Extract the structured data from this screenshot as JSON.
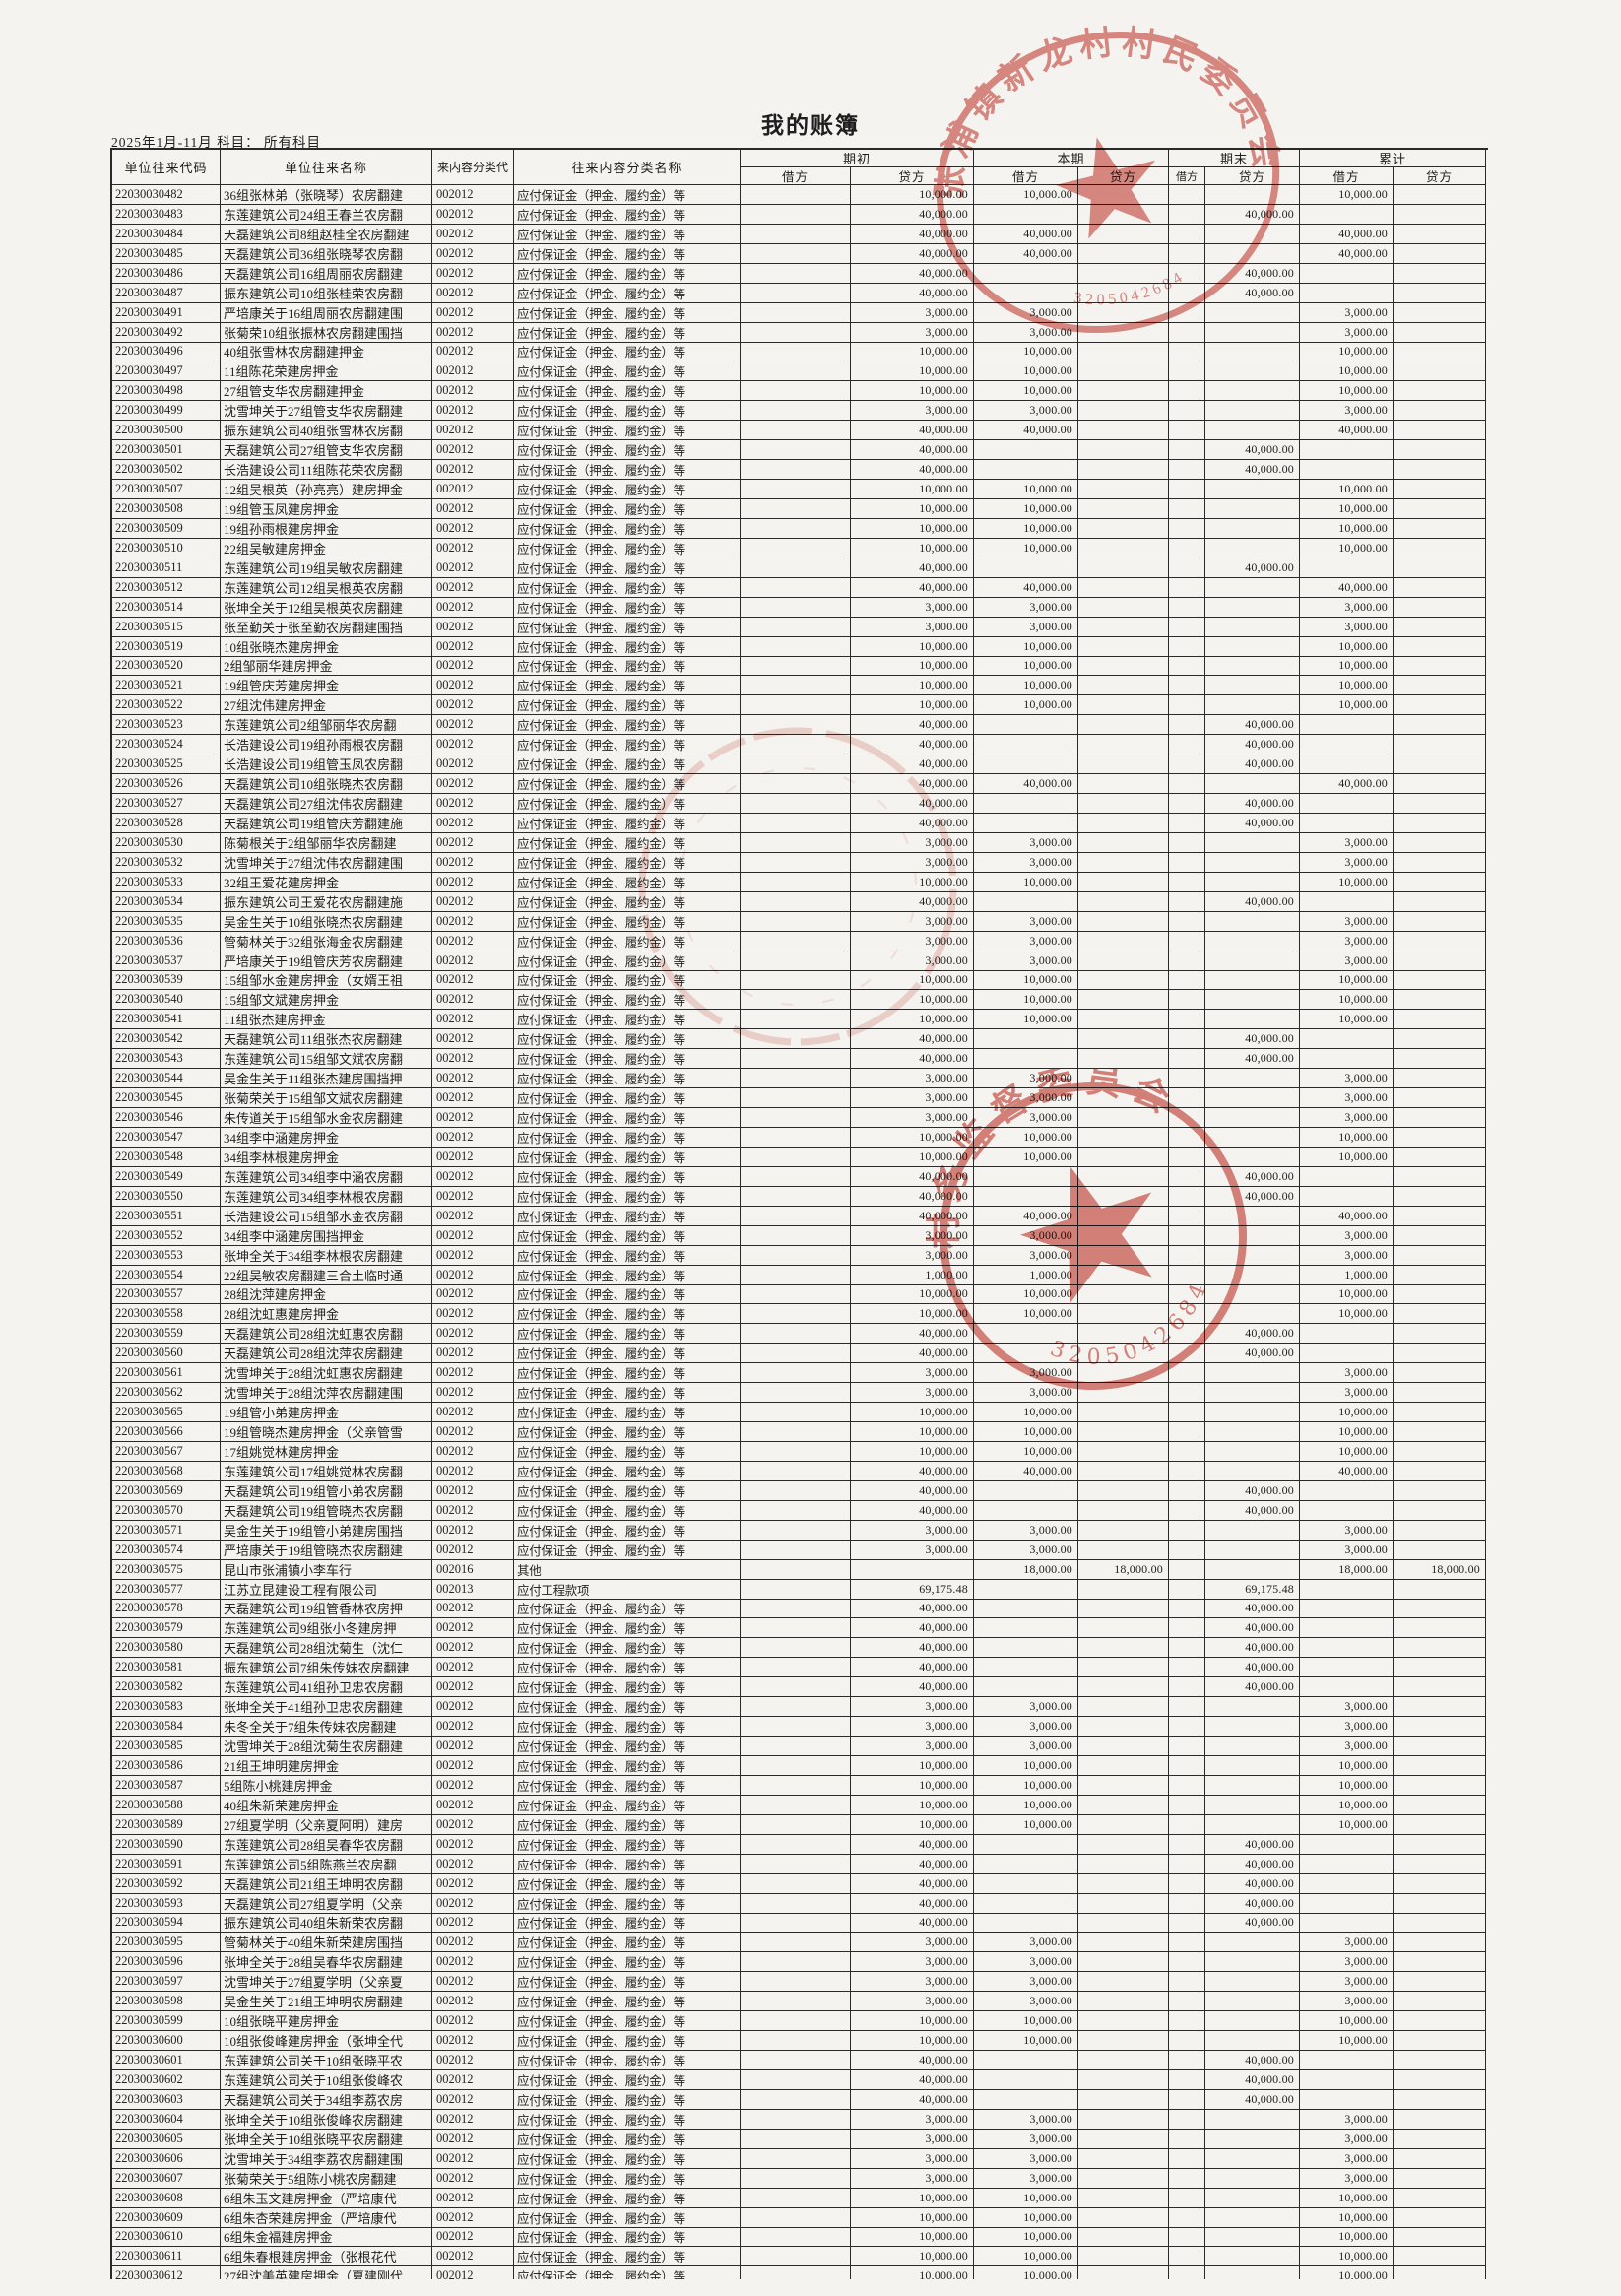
{
  "page": {
    "title": "我的账簿",
    "subtitle": "2025年1月-11月 科目： 所有科目"
  },
  "table": {
    "headers": {
      "code": "单位往来代码",
      "name": "单位往来名称",
      "class_code": "来内容分类代",
      "class_name": "往来内容分类名称",
      "groups": [
        "期初",
        "本期",
        "期末",
        "累计"
      ],
      "debit": "借方",
      "credit": "贷方"
    },
    "types": {
      "b": "应付保证金（押金、履约金）等",
      "o": "其他",
      "g": "应付工程款项"
    },
    "patterns": {
      "s10": [
        "",
        "10,000.00",
        "10,000.00",
        "",
        "",
        "",
        "10,000.00",
        ""
      ],
      "s40": [
        "",
        "40,000.00",
        "40,000.00",
        "",
        "",
        "",
        "40,000.00",
        ""
      ],
      "s3": [
        "",
        "3,000.00",
        "3,000.00",
        "",
        "",
        "",
        "3,000.00",
        ""
      ],
      "s1": [
        "",
        "1,000.00",
        "1,000.00",
        "",
        "",
        "",
        "1,000.00",
        ""
      ],
      "o40": [
        "",
        "40,000.00",
        "",
        "",
        "",
        "40,000.00",
        "",
        ""
      ],
      "x18": [
        "",
        "",
        "18,000.00",
        "18,000.00",
        "",
        "",
        "18,000.00",
        "18,000.00"
      ],
      "x69": [
        "",
        "69,175.48",
        "",
        "",
        "",
        "69,175.48",
        "",
        ""
      ]
    },
    "rows": [
      [
        "22030030482",
        "36组张林弟（张晓琴）农房翻建",
        "002012",
        "b",
        "s10"
      ],
      [
        "22030030483",
        "东莲建筑公司24组王春兰农房翻",
        "002012",
        "b",
        "o40"
      ],
      [
        "22030030484",
        "天磊建筑公司8组赵桂全农房翻建",
        "002012",
        "b",
        "s40"
      ],
      [
        "22030030485",
        "天磊建筑公司36组张晓琴农房翻",
        "002012",
        "b",
        "s40"
      ],
      [
        "22030030486",
        "天磊建筑公司16组周丽农房翻建",
        "002012",
        "b",
        "o40"
      ],
      [
        "22030030487",
        "振东建筑公司10组张桂荣农房翻",
        "002012",
        "b",
        "o40"
      ],
      [
        "22030030491",
        "严培康关于16组周丽农房翻建围",
        "002012",
        "b",
        "s3"
      ],
      [
        "22030030492",
        "张菊荣10组张振林农房翻建围挡",
        "002012",
        "b",
        "s3"
      ],
      [
        "22030030496",
        "40组张雪林农房翻建押金",
        "002012",
        "b",
        "s10"
      ],
      [
        "22030030497",
        "11组陈花荣建房押金",
        "002012",
        "b",
        "s10"
      ],
      [
        "22030030498",
        "27组管支华农房翻建押金",
        "002012",
        "b",
        "s10"
      ],
      [
        "22030030499",
        "沈雪坤关于27组管支华农房翻建",
        "002012",
        "b",
        "s3"
      ],
      [
        "22030030500",
        "振东建筑公司40组张雪林农房翻",
        "002012",
        "b",
        "s40"
      ],
      [
        "22030030501",
        "天磊建筑公司27组管支华农房翻",
        "002012",
        "b",
        "o40"
      ],
      [
        "22030030502",
        "长浩建设公司11组陈花荣农房翻",
        "002012",
        "b",
        "o40"
      ],
      [
        "22030030507",
        "12组吴根英（孙亮亮）建房押金",
        "002012",
        "b",
        "s10"
      ],
      [
        "22030030508",
        "19组管玉凤建房押金",
        "002012",
        "b",
        "s10"
      ],
      [
        "22030030509",
        "19组孙雨根建房押金",
        "002012",
        "b",
        "s10"
      ],
      [
        "22030030510",
        "22组吴敏建房押金",
        "002012",
        "b",
        "s10"
      ],
      [
        "22030030511",
        "东莲建筑公司19组吴敏农房翻建",
        "002012",
        "b",
        "o40"
      ],
      [
        "22030030512",
        "东莲建筑公司12组吴根英农房翻",
        "002012",
        "b",
        "s40"
      ],
      [
        "22030030514",
        "张坤全关于12组吴根英农房翻建",
        "002012",
        "b",
        "s3"
      ],
      [
        "22030030515",
        "张至勤关于张至勤农房翻建围挡",
        "002012",
        "b",
        "s3"
      ],
      [
        "22030030519",
        "10组张晓杰建房押金",
        "002012",
        "b",
        "s10"
      ],
      [
        "22030030520",
        "2组邹丽华建房押金",
        "002012",
        "b",
        "s10"
      ],
      [
        "22030030521",
        "19组管庆芳建房押金",
        "002012",
        "b",
        "s10"
      ],
      [
        "22030030522",
        "27组沈伟建房押金",
        "002012",
        "b",
        "s10"
      ],
      [
        "22030030523",
        "东莲建筑公司2组邹丽华农房翻",
        "002012",
        "b",
        "o40"
      ],
      [
        "22030030524",
        "长浩建设公司19组孙雨根农房翻",
        "002012",
        "b",
        "o40"
      ],
      [
        "22030030525",
        "长浩建设公司19组管玉凤农房翻",
        "002012",
        "b",
        "o40"
      ],
      [
        "22030030526",
        "天磊建筑公司10组张晓杰农房翻",
        "002012",
        "b",
        "s40"
      ],
      [
        "22030030527",
        "天磊建筑公司27组沈伟农房翻建",
        "002012",
        "b",
        "o40"
      ],
      [
        "22030030528",
        "天磊建筑公司19组管庆芳翻建施",
        "002012",
        "b",
        "o40"
      ],
      [
        "22030030530",
        "陈菊根关于2组邹丽华农房翻建",
        "002012",
        "b",
        "s3"
      ],
      [
        "22030030532",
        "沈雪坤关于27组沈伟农房翻建围",
        "002012",
        "b",
        "s3"
      ],
      [
        "22030030533",
        "32组王爱花建房押金",
        "002012",
        "b",
        "s10"
      ],
      [
        "22030030534",
        "振东建筑公司王爱花农房翻建施",
        "002012",
        "b",
        "o40"
      ],
      [
        "22030030535",
        "吴金生关于10组张晓杰农房翻建",
        "002012",
        "b",
        "s3"
      ],
      [
        "22030030536",
        "管菊林关于32组张海金农房翻建",
        "002012",
        "b",
        "s3"
      ],
      [
        "22030030537",
        "严培康关于19组管庆芳农房翻建",
        "002012",
        "b",
        "s3"
      ],
      [
        "22030030539",
        "15组邹水金建房押金（女婿王祖",
        "002012",
        "b",
        "s10"
      ],
      [
        "22030030540",
        "15组邹文斌建房押金",
        "002012",
        "b",
        "s10"
      ],
      [
        "22030030541",
        "11组张杰建房押金",
        "002012",
        "b",
        "s10"
      ],
      [
        "22030030542",
        "天磊建筑公司11组张杰农房翻建",
        "002012",
        "b",
        "o40"
      ],
      [
        "22030030543",
        "东莲建筑公司15组邹文斌农房翻",
        "002012",
        "b",
        "o40"
      ],
      [
        "22030030544",
        "吴金生关于11组张杰建房围挡押",
        "002012",
        "b",
        "s3"
      ],
      [
        "22030030545",
        "张菊荣关于15组邹文斌农房翻建",
        "002012",
        "b",
        "s3"
      ],
      [
        "22030030546",
        "朱传道关于15组邹水金农房翻建",
        "002012",
        "b",
        "s3"
      ],
      [
        "22030030547",
        "34组李中涵建房押金",
        "002012",
        "b",
        "s10"
      ],
      [
        "22030030548",
        "34组李林根建房押金",
        "002012",
        "b",
        "s10"
      ],
      [
        "22030030549",
        "东莲建筑公司34组李中涵农房翻",
        "002012",
        "b",
        "o40"
      ],
      [
        "22030030550",
        "东莲建筑公司34组李林根农房翻",
        "002012",
        "b",
        "o40"
      ],
      [
        "22030030551",
        "长浩建设公司15组邹水金农房翻",
        "002012",
        "b",
        "s40"
      ],
      [
        "22030030552",
        "34组李中涵建房围挡押金",
        "002012",
        "b",
        "s3"
      ],
      [
        "22030030553",
        "张坤全关于34组李林根农房翻建",
        "002012",
        "b",
        "s3"
      ],
      [
        "22030030554",
        "22组吴敏农房翻建三合土临时通",
        "002012",
        "b",
        "s1"
      ],
      [
        "22030030557",
        "28组沈萍建房押金",
        "002012",
        "b",
        "s10"
      ],
      [
        "22030030558",
        "28组沈虹惠建房押金",
        "002012",
        "b",
        "s10"
      ],
      [
        "22030030559",
        "天磊建筑公司28组沈虹惠农房翻",
        "002012",
        "b",
        "o40"
      ],
      [
        "22030030560",
        "天磊建筑公司28组沈萍农房翻建",
        "002012",
        "b",
        "o40"
      ],
      [
        "22030030561",
        "沈雪坤关于28组沈虹惠农房翻建",
        "002012",
        "b",
        "s3"
      ],
      [
        "22030030562",
        "沈雪坤关于28组沈萍农房翻建围",
        "002012",
        "b",
        "s3"
      ],
      [
        "22030030565",
        "19组管小弟建房押金",
        "002012",
        "b",
        "s10"
      ],
      [
        "22030030566",
        "19组管晓杰建房押金（父亲管雪",
        "002012",
        "b",
        "s10"
      ],
      [
        "22030030567",
        "17组姚觉林建房押金",
        "002012",
        "b",
        "s10"
      ],
      [
        "22030030568",
        "东莲建筑公司17组姚觉林农房翻",
        "002012",
        "b",
        "s40"
      ],
      [
        "22030030569",
        "天磊建筑公司19组管小弟农房翻",
        "002012",
        "b",
        "o40"
      ],
      [
        "22030030570",
        "天磊建筑公司19组管晓杰农房翻",
        "002012",
        "b",
        "o40"
      ],
      [
        "22030030571",
        "吴金生关于19组管小弟建房围挡",
        "002012",
        "b",
        "s3"
      ],
      [
        "22030030574",
        "严培康关于19组管晓杰农房翻建",
        "002012",
        "b",
        "s3"
      ],
      [
        "22030030575",
        "昆山市张浦镇小李车行",
        "002016",
        "o",
        "x18"
      ],
      [
        "22030030577",
        "江苏立昆建设工程有限公司",
        "002013",
        "g",
        "x69"
      ],
      [
        "22030030578",
        "天磊建筑公司19组管香林农房押",
        "002012",
        "b",
        "o40"
      ],
      [
        "22030030579",
        "东莲建筑公司9组张小冬建房押",
        "002012",
        "b",
        "o40"
      ],
      [
        "22030030580",
        "天磊建筑公司28组沈菊生（沈仁",
        "002012",
        "b",
        "o40"
      ],
      [
        "22030030581",
        "振东建筑公司7组朱传妹农房翻建",
        "002012",
        "b",
        "o40"
      ],
      [
        "22030030582",
        "东莲建筑公司41组孙卫忠农房翻",
        "002012",
        "b",
        "o40"
      ],
      [
        "22030030583",
        "张坤全关于41组孙卫忠农房翻建",
        "002012",
        "b",
        "s3"
      ],
      [
        "22030030584",
        "朱冬全关于7组朱传妹农房翻建",
        "002012",
        "b",
        "s3"
      ],
      [
        "22030030585",
        "沈雪坤关于28组沈菊生农房翻建",
        "002012",
        "b",
        "s3"
      ],
      [
        "22030030586",
        "21组王坤明建房押金",
        "002012",
        "b",
        "s10"
      ],
      [
        "22030030587",
        "5组陈小桃建房押金",
        "002012",
        "b",
        "s10"
      ],
      [
        "22030030588",
        "40组朱新荣建房押金",
        "002012",
        "b",
        "s10"
      ],
      [
        "22030030589",
        "27组夏学明（父亲夏阿明）建房",
        "002012",
        "b",
        "s10"
      ],
      [
        "22030030590",
        "东莲建筑公司28组吴春华农房翻",
        "002012",
        "b",
        "o40"
      ],
      [
        "22030030591",
        "东莲建筑公司5组陈燕兰农房翻",
        "002012",
        "b",
        "o40"
      ],
      [
        "22030030592",
        "天磊建筑公司21组王坤明农房翻",
        "002012",
        "b",
        "o40"
      ],
      [
        "22030030593",
        "天磊建筑公司27组夏学明（父亲",
        "002012",
        "b",
        "o40"
      ],
      [
        "22030030594",
        "振东建筑公司40组朱新荣农房翻",
        "002012",
        "b",
        "o40"
      ],
      [
        "22030030595",
        "管菊林关于40组朱新荣建房围挡",
        "002012",
        "b",
        "s3"
      ],
      [
        "22030030596",
        "张坤全关于28组吴春华农房翻建",
        "002012",
        "b",
        "s3"
      ],
      [
        "22030030597",
        "沈雪坤关于27组夏学明（父亲夏",
        "002012",
        "b",
        "s3"
      ],
      [
        "22030030598",
        "吴金生关于21组王坤明农房翻建",
        "002012",
        "b",
        "s3"
      ],
      [
        "22030030599",
        "10组张晓平建房押金",
        "002012",
        "b",
        "s10"
      ],
      [
        "22030030600",
        "10组张俊峰建房押金（张坤全代",
        "002012",
        "b",
        "s10"
      ],
      [
        "22030030601",
        "东莲建筑公司关于10组张晓平农",
        "002012",
        "b",
        "o40"
      ],
      [
        "22030030602",
        "东莲建筑公司关于10组张俊峰农",
        "002012",
        "b",
        "o40"
      ],
      [
        "22030030603",
        "天磊建筑公司关于34组李荔农房",
        "002012",
        "b",
        "o40"
      ],
      [
        "22030030604",
        "张坤全关于10组张俊峰农房翻建",
        "002012",
        "b",
        "s3"
      ],
      [
        "22030030605",
        "张坤全关于10组张晓平农房翻建",
        "002012",
        "b",
        "s3"
      ],
      [
        "22030030606",
        "沈雪坤关于34组李荔农房翻建围",
        "002012",
        "b",
        "s3"
      ],
      [
        "22030030607",
        "张菊荣关于5组陈小桃农房翻建",
        "002012",
        "b",
        "s3"
      ],
      [
        "22030030608",
        "6组朱玉文建房押金（严培康代",
        "002012",
        "b",
        "s10"
      ],
      [
        "22030030609",
        "6组朱杏荣建房押金（严培康代",
        "002012",
        "b",
        "s10"
      ],
      [
        "22030030610",
        "6组朱金福建房押金",
        "002012",
        "b",
        "s10"
      ],
      [
        "22030030611",
        "6组朱春根建房押金（张根花代",
        "002012",
        "b",
        "s10"
      ],
      [
        "22030030612",
        "27组沈美英建房押金（夏建刚代",
        "002012",
        "b",
        "s10"
      ]
    ]
  },
  "stamps": {
    "top_text": "张浦镇新龙村村民委员会",
    "mid_text": "村务监督委员会",
    "mid_serial": "3205042684"
  },
  "colors": {
    "stamp_red": "#c63a2f",
    "ink": "#262626",
    "paper": "#f4f3ef"
  }
}
